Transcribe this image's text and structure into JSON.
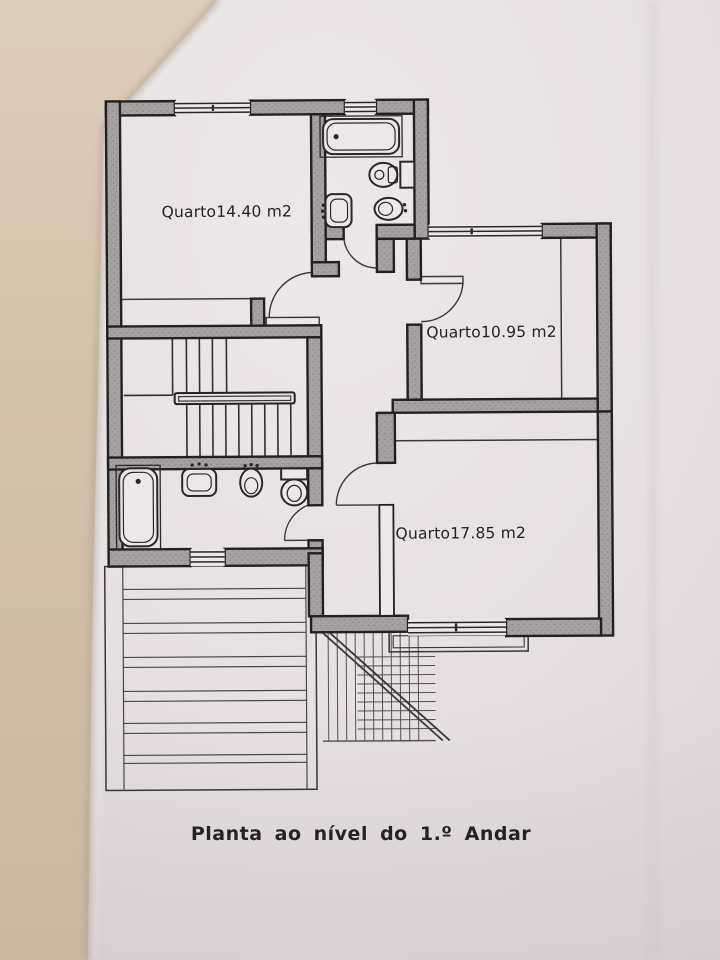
{
  "document": {
    "title": "Planta ao nível do 1.º Andar",
    "kind": "architectural floor plan photo"
  },
  "rooms": [
    {
      "name": "bedroom-1",
      "label": "Quarto14.40  m2"
    },
    {
      "name": "bedroom-2",
      "label": "Quarto10.95  m2"
    },
    {
      "name": "bedroom-3",
      "label": "Quarto17.85  m2"
    }
  ],
  "fixtures": {
    "bathroom_top": [
      "bathtub-icon",
      "toilet-icon",
      "sink-icon",
      "bidet-icon"
    ],
    "bathroom_bottom": [
      "bathtub-icon",
      "sink-icon",
      "bidet-icon",
      "toilet-icon"
    ]
  },
  "features": [
    "staircase",
    "handrail",
    "roof-hatching",
    "stairs-below-hatching",
    "windows",
    "door-swings"
  ],
  "colors": {
    "paper": "#e8e3e4",
    "page_edge_tan": "#d3c3af",
    "wall_fill": "#a6a2a1",
    "outline_black": "#232021",
    "thin_line": "#3b3739",
    "text": "#242129"
  }
}
